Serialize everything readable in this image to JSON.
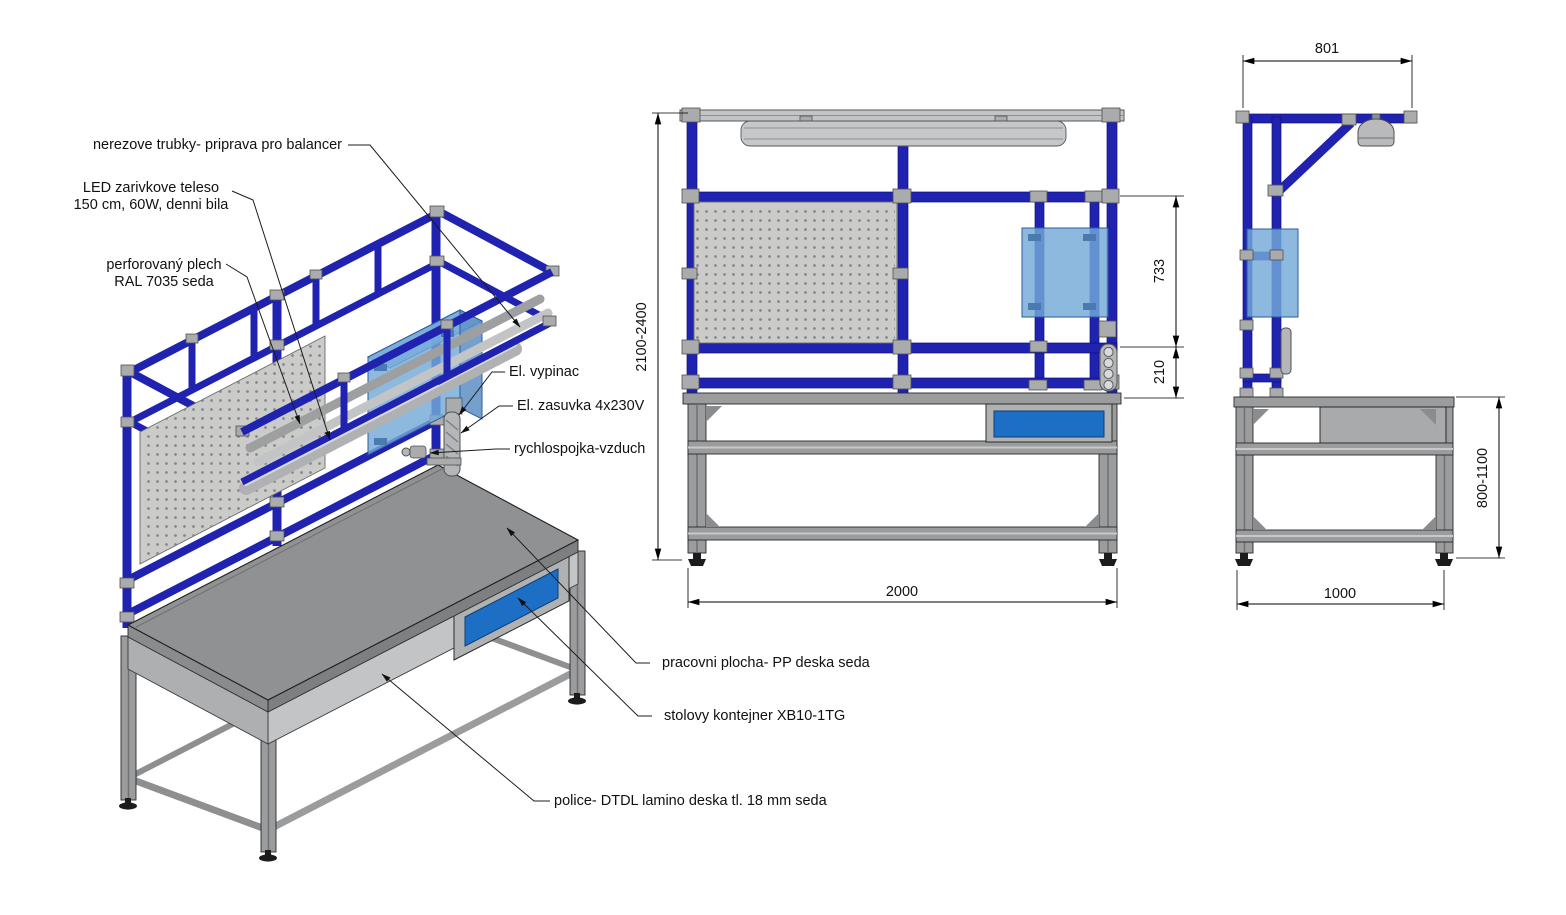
{
  "drawing": {
    "annotations": {
      "balancer": "nerezove trubky- priprava pro balancer",
      "led_line1": "LED zarivkove teleso",
      "led_line2": "150 cm, 60W, denni bila",
      "perf_line1": "perforovaný plech",
      "perf_line2": "RAL 7035 seda",
      "switch": "El. vypinac",
      "socket": "El. zasuvka 4x230V",
      "air_coupling": "rychlospojka-vzduch",
      "worktop": "pracovni plocha- PP deska seda",
      "container": "stolovy kontejner XB10-1TG",
      "shelf": "police- DTDL lamino deska tl. 18 mm seda"
    },
    "dimensions": {
      "overall_height": "2100-2400",
      "panel_height": "733",
      "gap_height": "210",
      "bench_width": "2000",
      "frame_depth": "801",
      "bench_height": "800-1100",
      "bench_depth": "1000"
    },
    "colors": {
      "tube_blue": "#2023b0",
      "panel_blue": "#74a9d8",
      "drawer_blue": "#1c6fc4",
      "bench_gray": "#9b9c9e",
      "light_gray": "#c7c8c9",
      "peg_gray": "#cbccca"
    }
  }
}
